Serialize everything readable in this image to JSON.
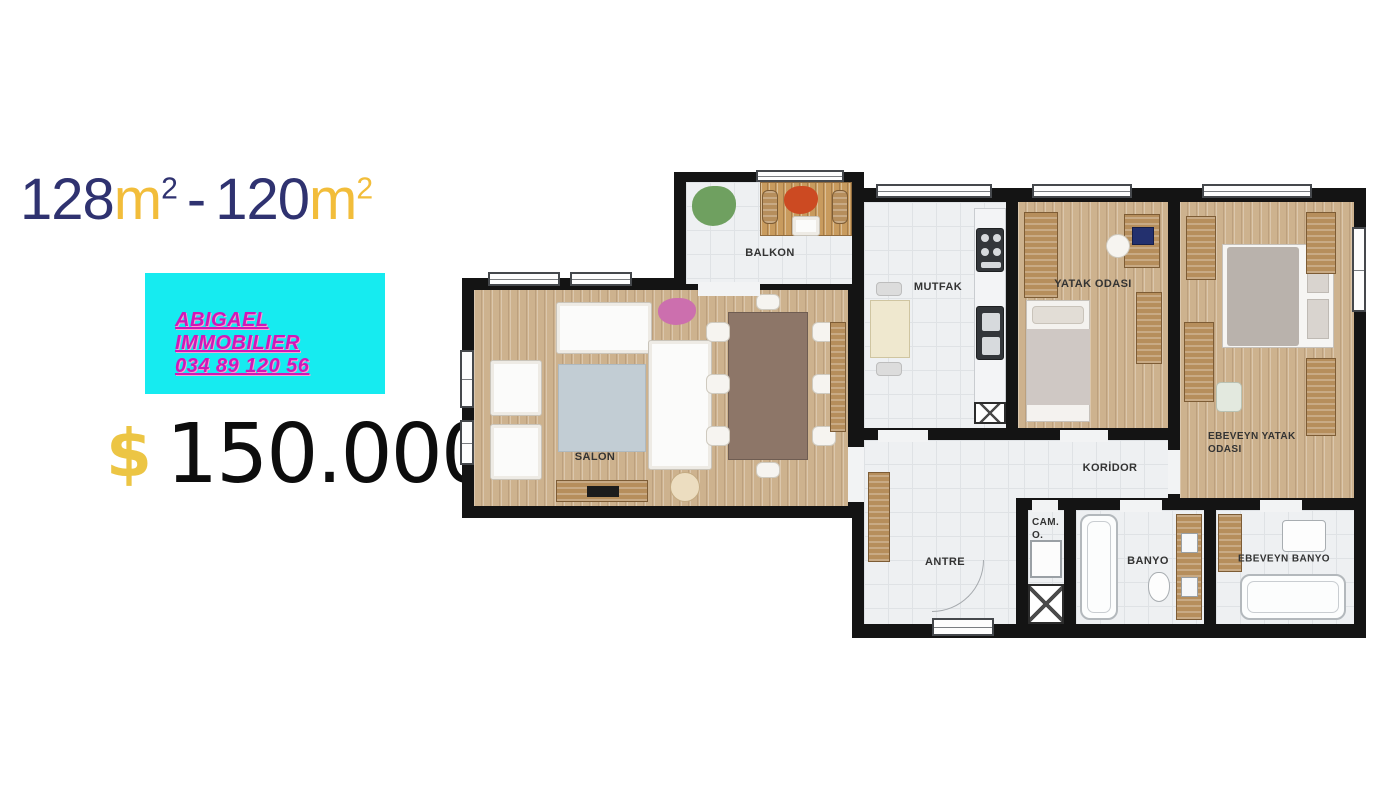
{
  "ad": {
    "area": {
      "num1": "128",
      "m1": "m",
      "sup1": "2",
      "sep": "-",
      "num2": "120",
      "m2": "m",
      "sup2": "2"
    },
    "agency": {
      "line1": "ABIGAEL",
      "line2": "IMMOBILIER",
      "phone": "034 89 120 56"
    },
    "price": {
      "currency": "$",
      "amount": "150.000"
    }
  },
  "colors": {
    "navy": "#2f3270",
    "gold": "#f2bd3a",
    "cyan_box": "#16ebf0",
    "magenta_text": "#cf18b8",
    "price_black": "#0d0d0d",
    "wall_black": "#141414",
    "wood_floor": "#cdb28e",
    "tile_floor": "#eef0f2"
  },
  "floorplan": {
    "rooms": {
      "balkon": {
        "label": "BALKON"
      },
      "salon": {
        "label": "SALON"
      },
      "mutfak": {
        "label": "MUTFAK"
      },
      "yatak": {
        "label": "YATAK ODASI"
      },
      "ebeveyn_yatak": {
        "label_line1": "EBEVEYN YATAK",
        "label_line2": "ODASI"
      },
      "koridor": {
        "label": "KORİDOR"
      },
      "antre": {
        "label": "ANTRE"
      },
      "cam_o": {
        "label_line1": "CAM.",
        "label_line2": "O."
      },
      "banyo": {
        "label": "BANYO"
      },
      "ebeveyn_banyo": {
        "label": "EBEVEYN BANYO"
      }
    }
  }
}
